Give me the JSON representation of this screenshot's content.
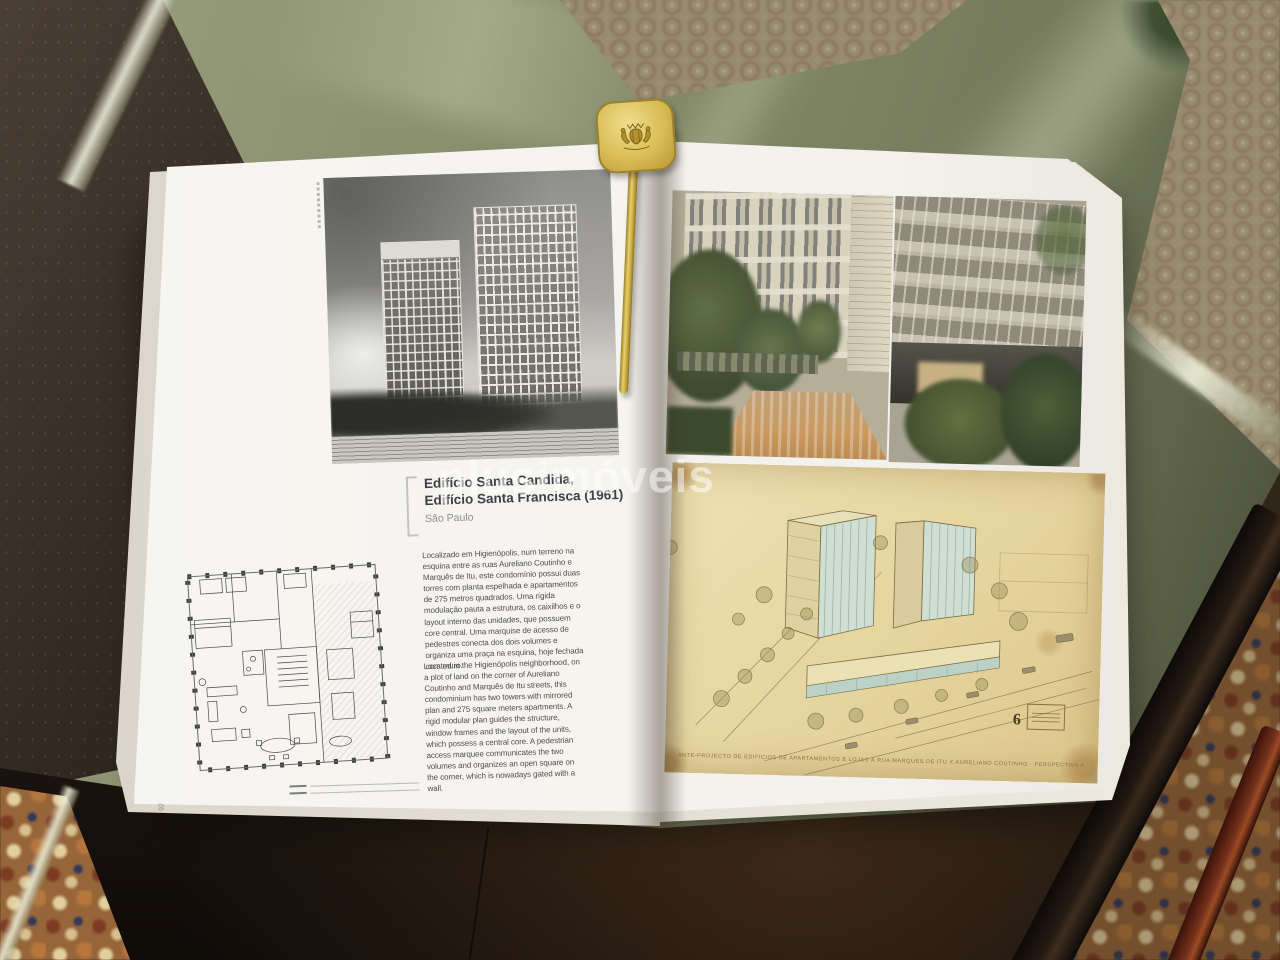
{
  "scene": {
    "watermark": "plusimóveis",
    "colors": {
      "glass_green": "#848a68",
      "bookmark_gold": "#d6b84f",
      "drawing_paper": "#e7d7a4",
      "carpet_rose": "#b78d7e",
      "carpet_border": "#96653a"
    }
  },
  "book": {
    "left_page": {
      "page_number": "92",
      "title_line1": "Edifício Santa Candida,",
      "title_line2": "Edifício Santa Francisca (1961)",
      "subtitle": "São Paulo",
      "paragraph_pt": "Localizado em Higienópolis, num terreno na esquina entre as ruas Aureliano Coutinho e Marquês de Itu, este condomínio possui duas torres com planta espelhada e apartamentos de 275 metros quadrados. Uma rígida modulação pauta a estrutura, os caixilhos e o layout interno das unidades, que possuem core central. Uma marquise de acesso de pedestres conecta dos dois volumes e organiza uma praça na esquina, hoje fechada com muro.",
      "paragraph_en": "Located in the Higienópolis neighborhood, on a plot of land on the corner of Aureliano Coutinho and Marquês de Itu streets, this condominium has two towers with mirrored plan and 275 square meters apartments. A rigid modular plan guides the structure, window frames and the layout of the units, which possess a central core. A pedestrian access marquee communicates the two volumes and organizes an open square on the corner, which is nowadays gated with a wall."
    },
    "right_page": {
      "page_number": "93",
      "drawing_caption": "ANTE-PROJECTO DE EDIFICIOS DE APARTAMENTOS E LOJAS À RUA MARQUES DE ITU X AURELIANO COUTINHO · PERSPECTIVA À VOL D'OISEAU",
      "drawing_number": "6"
    }
  }
}
